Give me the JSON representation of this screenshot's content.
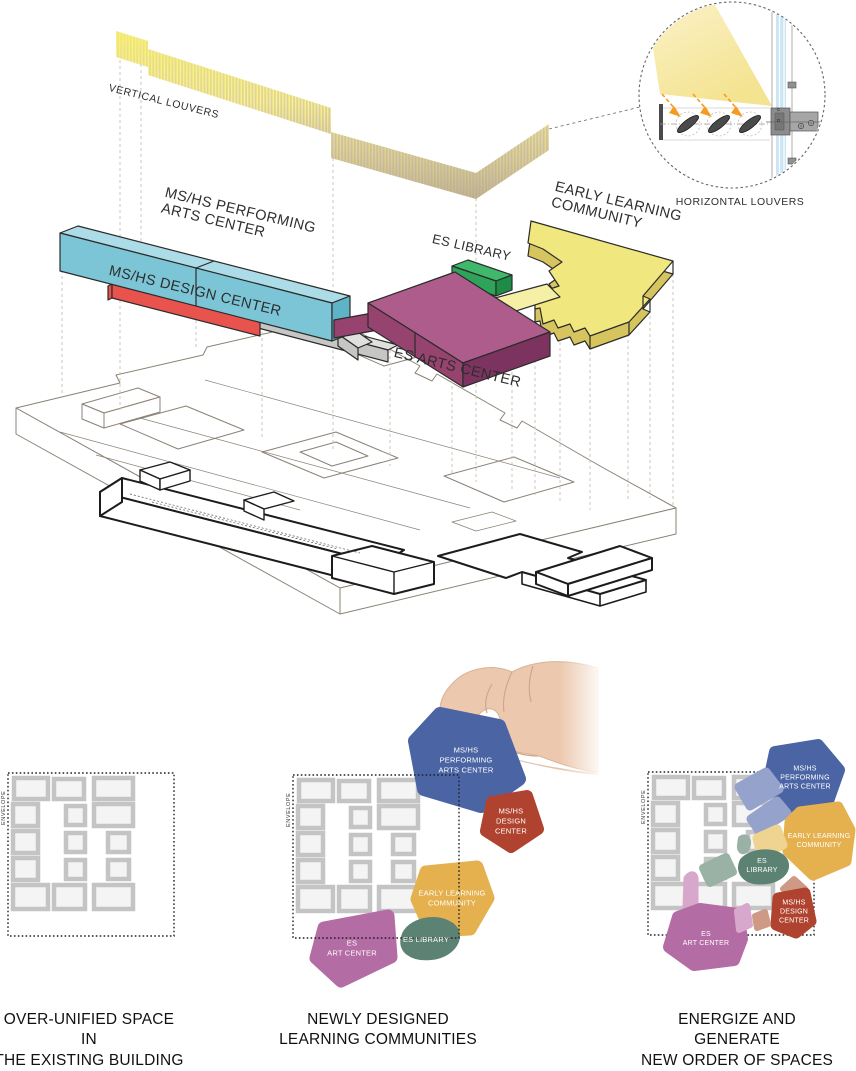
{
  "colors": {
    "performing_front": "#7CC5D6",
    "performing_top": "#ABDCE7",
    "design_red": "#E9534E",
    "arts_top": "#AD5C8C",
    "arts_front": "#97436F",
    "library_green": "#2EA45A",
    "elc_yellow": "#F0E87E",
    "connector_gray": "#C6C6C4",
    "blob_blue": "#4B65A4",
    "blob_red": "#B0432F",
    "blob_yellow": "#E5B04E",
    "blob_green": "#5C8273",
    "blob_purple": "#B46CA4",
    "beam_yellow": "#F2DE7C",
    "glass_blue": "#CBE5F5",
    "arrow_orange": "#F59B20"
  },
  "axon": {
    "vertical_louvers_label": "VERTICAL LOUVERS",
    "horizontal_louvers_label": "HORIZONTAL LOUVERS",
    "performing_label": "MS/HS PERFORMING\nARTS CENTER",
    "design_label": "MS/HS DESIGN CENTER",
    "library_label": "ES LIBRARY",
    "arts_label": "ES ARTS CENTER",
    "elc_label": "EARLY LEARNING\nCOMMUNITY",
    "glass_marking": "C\nD"
  },
  "panels": [
    {
      "envelope_label": "ENVELOPE",
      "caption": "OVER-UNIFIED SPACE IN\nTHE EXISTING BUILDING"
    },
    {
      "envelope_label": "ENVELOPE",
      "caption": "NEWLY DESIGNED\nLEARNING COMMUNITIES",
      "blobs": {
        "performing": "MS/HS\nPERFORMING\nARTS CENTER",
        "design": "MS/HS\nDESIGN\nCENTER",
        "elc": "EARLY LEARNING\nCOMMUNITY",
        "library": "ES LIBRARY",
        "art": "ES\nART CENTER"
      }
    },
    {
      "envelope_label": "ENVELOPE",
      "caption": "ENERGIZE AND GENERATE\nNEW ORDER OF SPACES",
      "blobs": {
        "performing": "MS/HS\nPERFORMING\nARTS CENTER",
        "elc": "EARLY LEARNING\nCOMMUNITY",
        "library": "ES\nLIBRARY",
        "design": "MS/HS\nDESIGN\nCENTER",
        "art": "ES\nART CENTER"
      }
    }
  ]
}
